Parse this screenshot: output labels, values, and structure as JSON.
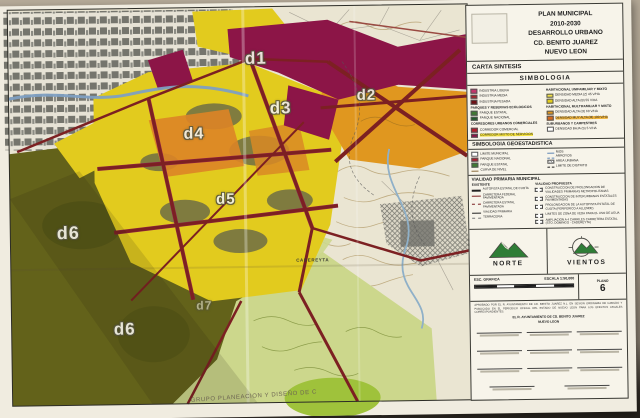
{
  "photo": {
    "background_top": "#b6ab99",
    "background_bottom": "#26221c"
  },
  "map": {
    "credit": "GRUPO PLANEACION Y DISEÑO DE C",
    "districts": [
      {
        "label": "d1"
      },
      {
        "label": "d2"
      },
      {
        "label": "d3"
      },
      {
        "label": "d4"
      },
      {
        "label": "d5"
      },
      {
        "label": "d6"
      },
      {
        "label": "d6"
      },
      {
        "label": "d7"
      }
    ],
    "places": [
      {
        "label": "CADEREYTA"
      }
    ],
    "colors": {
      "cream": "#eae5d2",
      "yellow": "#e2cb1e",
      "orange": "#e0971f",
      "maroon": "#8c1547",
      "olive": "#63621a",
      "light_green": "#ccd78c",
      "bright_green": "#9fc23b",
      "road_red": "#7c2022",
      "river_blue": "#7e9fc2",
      "urban_gray": "#75756d"
    }
  },
  "panel": {
    "title": [
      "PLAN MUNICIPAL",
      "2010-2030",
      "DESARROLLO URBANO",
      "CD. BENITO JUAREZ",
      "NUEVO LEON"
    ],
    "carta_sintesis": "CARTA SINTESIS",
    "simbologia": "SIMBOLOGIA",
    "zoning": {
      "left": [
        {
          "items": [
            {
              "label": "INDUSTRIA LIGERA",
              "color": "#c4356b"
            },
            {
              "label": "INDUSTRIA MEDIA",
              "color": "#a8222c"
            },
            {
              "label": "INDUSTRIA PESADA",
              "color": "#6f1216"
            }
          ]
        },
        {
          "header": "PARQUES Y RESERVAS ECOLOGICOS",
          "items": [
            {
              "label": "PARQUE ESTATAL",
              "color": "#3f7a33"
            },
            {
              "label": "PARQUE NACIONAL",
              "color": "#1f5c2a"
            }
          ]
        },
        {
          "header": "CORREDORES URBANOS COMERCIALES",
          "items": [
            {
              "label": "CORREDOR COMERCIAL",
              "color": "#b02030"
            },
            {
              "label": "CORREDOR MIXTO DE SERVICIOS",
              "color": "#8c1547"
            }
          ]
        }
      ],
      "right": [
        {
          "header": "HABITACIONAL UNIFAMILIAR Y MIXTO",
          "items": [
            {
              "label": "DENSIDAD MEDIA (Z) 45 V/HA",
              "color": "#f0e049"
            },
            {
              "label": "DENSIDAD ALTA (B) 55 V/HA",
              "color": "#e3cd1e"
            }
          ]
        },
        {
          "header": "HABITACIONAL MULTIFAMILIAR Y MIXTO",
          "items": [
            {
              "label": "DENSIDAD ALTA (O) 60 V/HA",
              "color": "#e0971f"
            },
            {
              "label": "DENSIDAD MUY ALTA (M) 100 V/HA",
              "color": "#d2691e"
            }
          ]
        },
        {
          "header": "SUBURBANOS Y CAMPESTRES",
          "items": [
            {
              "label": "DENSIDAD BAJA (S) 5 V/HA",
              "color": "#ffffff"
            }
          ]
        }
      ]
    },
    "geo": {
      "title": "SIMBOLOGIA GEOESTADISTICA",
      "left": [
        {
          "label": "LIMITE MUNICIPAL"
        },
        {
          "label": "PARQUE NACIONAL"
        },
        {
          "label": "PARQUE ESTATAL"
        },
        {
          "label": "CURVA DE NIVEL"
        }
      ],
      "right": [
        {
          "label": "RIOS"
        },
        {
          "label": "ARROYOS"
        },
        {
          "label": "AREA URBANA"
        },
        {
          "label": "LIMITE DE DISTRITO"
        }
      ]
    },
    "vialidad": {
      "title": "VIALIDAD PRIMARIA MUNICIPAL",
      "existente_header": "EXISTENTE",
      "existente": [
        {
          "label": "AUTOPISTA ESTATAL DE CUOTA"
        },
        {
          "label": "CARRETERA FEDERAL PAVIMENTADA"
        },
        {
          "label": "CARRETERA ESTATAL PAVIMENTADA"
        },
        {
          "label": "VIALIDAD PRIMARIA"
        },
        {
          "label": "TERRACERIA"
        }
      ],
      "propuesta_header": "VIALIDAD PROPUESTA",
      "propuesta": [
        {
          "label": "CONSTRUCCION DE PROLONGACION DE VIALIDADES PRIMARIAS METROPOLITANAS"
        },
        {
          "label": "CONSTRUCCION DE INTERURBANAS ESTATALES PAVIMENTADAS"
        },
        {
          "label": "PROLONGACION DE LA AUTOPISTA ESTATAL DE CUOTA (PERIFERICO A ALLENDE)"
        },
        {
          "label": "LIMITES DE ZONA DE VEDA PARA EL USO DE AGUA"
        },
        {
          "label": "AMPLIACION A 4 CARRILES CARRETERA ESTATAL (STO. DOMINGO - CADEREYTA)"
        }
      ]
    },
    "norte": "NORTE",
    "vientos": "VIENTOS",
    "scale": {
      "label1": "ESC. GRAFICA",
      "label2": "ESCALA 1:50,000"
    },
    "plano": {
      "label": "PLANO",
      "number": "6"
    },
    "fineprint": "APROBADO POR EL R. AYUNTAMIENTO DE CD. BENITO JUAREZ N.L. EN SESION ORDINARIA DE CABILDO Y PUBLICADO EN EL PERIODICO OFICIAL DEL ESTADO DE NUEVO LEON PARA LOS EFECTOS LEGALES CORRESPONDIENTES.",
    "signatures": {
      "header": "EL R. AYUNTAMIENTO DE CD. BENITO JUAREZ",
      "subheader": "NUEVO LEON"
    }
  }
}
